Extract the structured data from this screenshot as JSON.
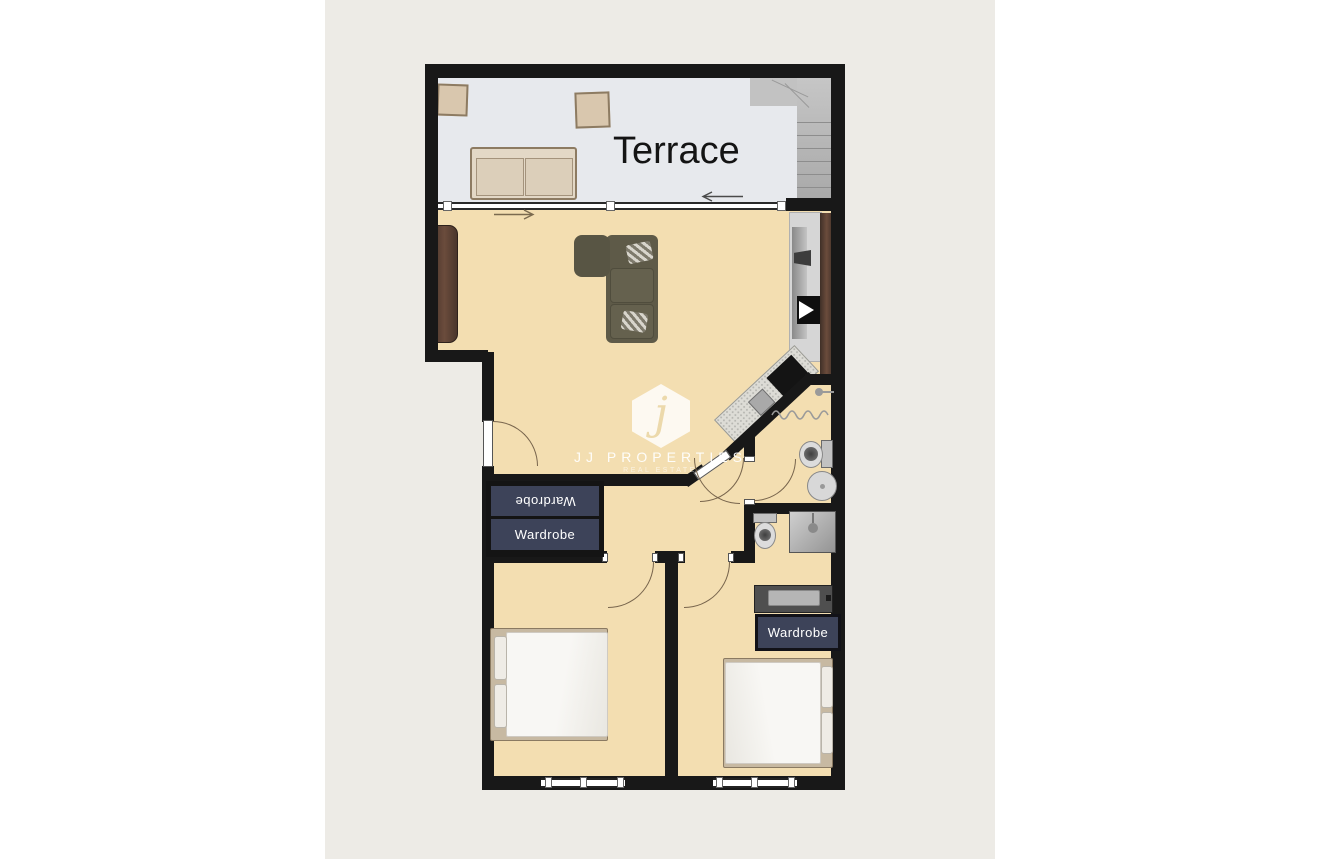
{
  "labels": {
    "terrace": "Terrace",
    "wardrobe_left_top": "Wardrobe",
    "wardrobe_left_bottom": "Wardrobe",
    "wardrobe_right": "Wardrobe"
  },
  "watermark": {
    "letter": "j",
    "name": "JJ PROPERTIES",
    "tagline": "REAL ESTATE"
  },
  "palette": {
    "page_background": "#ffffff",
    "canvas": "#edebe6",
    "wall": "#181818",
    "room_floor": "#f3deb1",
    "terrace_floor": "#e7e9ed",
    "wardrobe_navy": "#3d4359",
    "wood_brown": "#5a4034",
    "sofa_olive": "#5e5a48",
    "stair_gray": "#b5b5b5"
  }
}
